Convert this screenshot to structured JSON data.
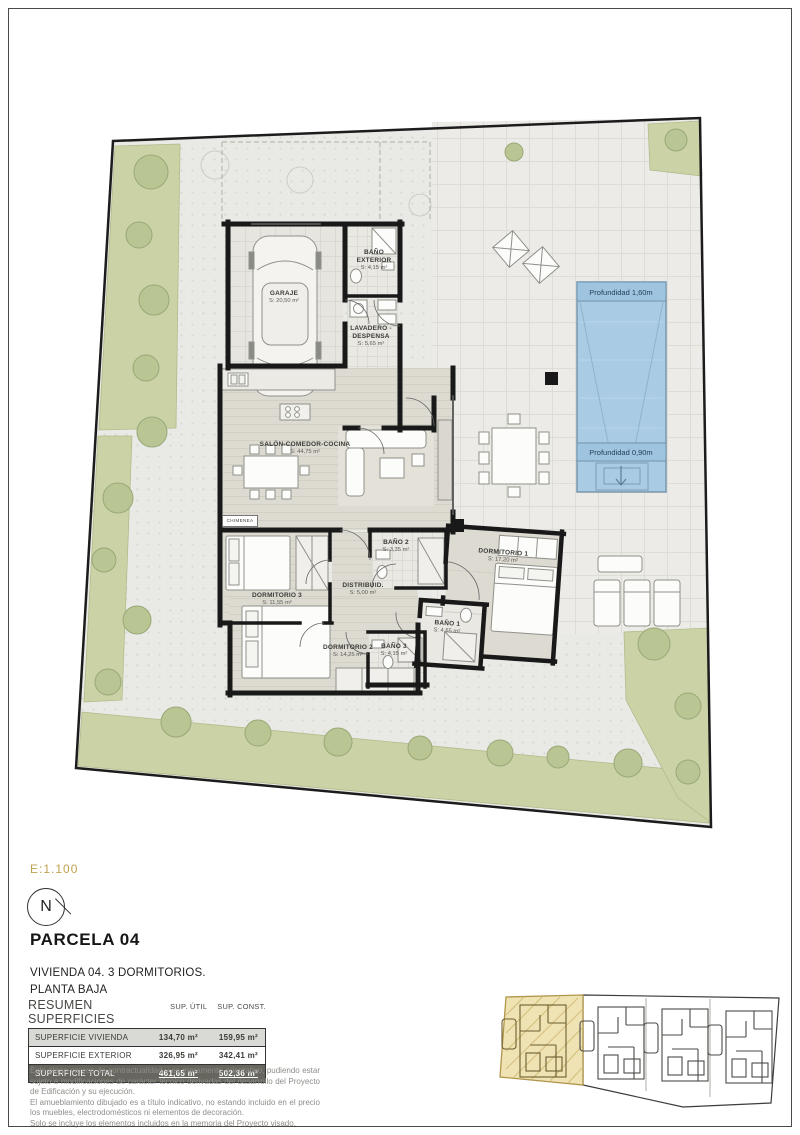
{
  "sheet": {
    "scale": "E:1.100",
    "compass_n": "N",
    "parcel_title": "PARCELA 04",
    "dwelling_line1": "VIVIENDA 04. 3 DORMITORIOS.",
    "dwelling_line2": "PLANTA BAJA"
  },
  "plan": {
    "rooms": {
      "garaje": {
        "name": "GARAJE",
        "area": "S: 20,50 m²"
      },
      "bano_exterior": {
        "name": "BAÑO EXTERIOR",
        "area": "S: 4,15 m²"
      },
      "lavadero": {
        "name": "LAVADERO - DESPENSA",
        "area": "S: 5,65 m²"
      },
      "salon": {
        "name": "SALÓN-COMEDOR-COCINA",
        "area": "S: 44,75 m²"
      },
      "dormitorio1": {
        "name": "DORMITORIO 1",
        "area": "S: 17,20 m²"
      },
      "dormitorio2": {
        "name": "DORMITORIO 2",
        "area": "S: 14,25 m²"
      },
      "dormitorio3": {
        "name": "DORMITORIO 3",
        "area": "S: 11,55 m²"
      },
      "distribuidor": {
        "name": "DISTRIBUID.",
        "area": "S: 5,00 m²"
      },
      "bano1": {
        "name": "BAÑO 1",
        "area": "S: 4,65 m²"
      },
      "bano2": {
        "name": "BAÑO 2",
        "area": "S: 3,35 m²"
      },
      "bano3": {
        "name": "BAÑO 3",
        "area": "S: 4,15 m²"
      }
    },
    "chimenea_label": "CHIMENEA",
    "pool": {
      "depth_deep": "Profundidad 1,60m",
      "depth_shallow": "Profundidad 0,90m"
    }
  },
  "summary": {
    "title": "RESUMEN SUPERFICIES",
    "col_util": "SUP. ÚTIL",
    "col_const": "SUP. CONST.",
    "rows": [
      {
        "label": "SUPERFICIE VIVIENDA",
        "util": "134,70 m²",
        "const": "159,95 m²"
      },
      {
        "label": "SUPERFICIE EXTERIOR",
        "util": "326,95 m²",
        "const": "342,41 m²"
      },
      {
        "label": "SUPERFICIE TOTAL",
        "util": "461,65 m²",
        "const": "502,36 m²"
      }
    ]
  },
  "disclaimer": {
    "p1": "Este plano carece de contractualidad y es meramente orientativo, pudiendo estar sujeto a modificaciones de carácter técnico derivadas del desarrollo del Proyecto de Edificación y su ejecución.",
    "p2": "El amueblamiento dibujado es a título indicativo, no estando incluido en el precio los muebles, electrodomésticos ni elementos de decoración.",
    "p3": "Solo se incluye los elementos incluidos en la memoria del Proyecto visado."
  },
  "colors": {
    "accent_gold": "#bfa14c",
    "pool_blue": "#a9cbe3",
    "vegetation_green": "#c9d2a4",
    "wall_black": "#191919"
  }
}
